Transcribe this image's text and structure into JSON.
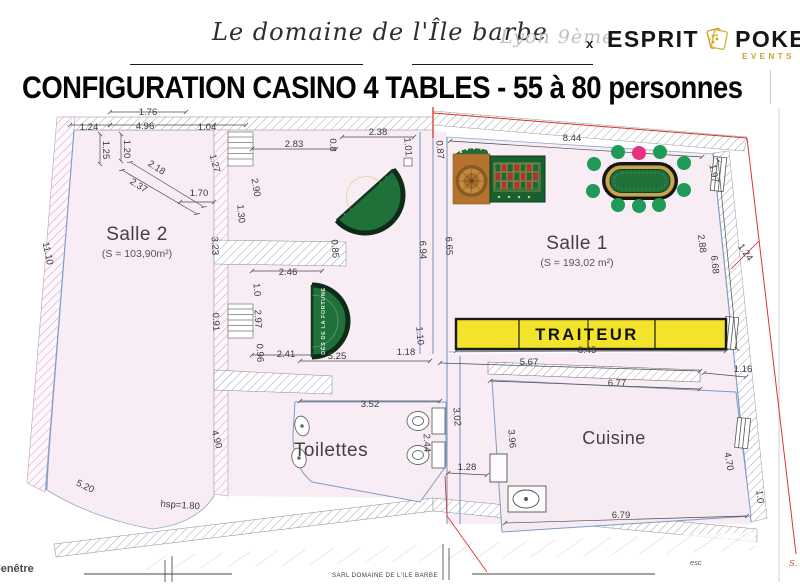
{
  "header": {
    "venue_name": "Le domaine de l'Île barbe",
    "venue_location": "Lyon 9ème",
    "collab_x": "x",
    "brand_left": "ESPRIT",
    "brand_right": "POKER",
    "brand_sub": "EVENTS",
    "title": "CONFIGURATION CASINO 4 TABLES - 55 à 80 personnes"
  },
  "plan": {
    "rooms": [
      {
        "name": "Salle 2",
        "area": "(S = 103,90m²)"
      },
      {
        "name": "Salle 1",
        "area": "(S = 193,02 m²)"
      },
      {
        "name": "Toilettes",
        "area": ""
      },
      {
        "name": "Cuisine",
        "area": ""
      }
    ],
    "traiteur_label": "TRAITEUR",
    "fortune_table_label": "DÉS DE LA FORTUNE",
    "footer": {
      "fenetre": "Fenêtre",
      "sarl": "SARL DOMAINE DE L'ILE BARBE",
      "esc": "esc",
      "s_mark": "S."
    },
    "colors": {
      "banner_yellow": "#f3e32b",
      "felt_green": "#20703a",
      "chair_green": "#1f9a57",
      "chair_pink": "#e8317e",
      "wood_brown": "#b4722f",
      "wall_blue": "#7e9cc5",
      "boundary_red": "#d9342b",
      "brand_gold": "#c9a227",
      "room_pink": "#f8edf4"
    },
    "poker_chairs": [
      {
        "x": 618,
        "y": 48,
        "pink": false
      },
      {
        "x": 639,
        "y": 49,
        "pink": true
      },
      {
        "x": 660,
        "y": 48,
        "pink": false
      },
      {
        "x": 594,
        "y": 60,
        "pink": false
      },
      {
        "x": 684,
        "y": 59,
        "pink": false
      },
      {
        "x": 593,
        "y": 87,
        "pink": false
      },
      {
        "x": 684,
        "y": 86,
        "pink": false
      },
      {
        "x": 618,
        "y": 101,
        "pink": false
      },
      {
        "x": 639,
        "y": 102,
        "pink": false
      },
      {
        "x": 659,
        "y": 101,
        "pink": false
      }
    ],
    "dimensions": [
      {
        "t": "1.76",
        "x": 148,
        "y": 11,
        "r": 0
      },
      {
        "t": "1.24",
        "x": 89,
        "y": 26,
        "r": 0
      },
      {
        "t": "4.96",
        "x": 145,
        "y": 25,
        "r": 0
      },
      {
        "t": "1.04",
        "x": 207,
        "y": 26,
        "r": 0
      },
      {
        "t": "1.25",
        "x": 103,
        "y": 46,
        "r": 90
      },
      {
        "t": "1.20",
        "x": 124,
        "y": 45,
        "r": 90
      },
      {
        "t": "2.18",
        "x": 155,
        "y": 66,
        "r": 33
      },
      {
        "t": "2.37",
        "x": 137,
        "y": 84,
        "r": 33
      },
      {
        "t": "1.70",
        "x": 199,
        "y": 92,
        "r": 0
      },
      {
        "t": "1.27",
        "x": 212,
        "y": 60,
        "r": 75
      },
      {
        "t": "2.90",
        "x": 253,
        "y": 84,
        "r": 80
      },
      {
        "t": "1.30",
        "x": 238,
        "y": 110,
        "r": 85
      },
      {
        "t": "3.23",
        "x": 212,
        "y": 142,
        "r": 88
      },
      {
        "t": "11.10",
        "x": 45,
        "y": 150,
        "r": 78
      },
      {
        "t": "2.83",
        "x": 294,
        "y": 43,
        "r": 0
      },
      {
        "t": "0.8",
        "x": 330,
        "y": 41,
        "r": 90
      },
      {
        "t": "2.38",
        "x": 378,
        "y": 31,
        "r": 0
      },
      {
        "t": "1.01",
        "x": 405,
        "y": 43,
        "r": 85
      },
      {
        "t": "0.87",
        "x": 437,
        "y": 46,
        "r": 85
      },
      {
        "t": "0.85",
        "x": 332,
        "y": 145,
        "r": 85
      },
      {
        "t": "6.94",
        "x": 420,
        "y": 146,
        "r": 88
      },
      {
        "t": "6.65",
        "x": 446,
        "y": 142,
        "r": 88
      },
      {
        "t": "2.46",
        "x": 288,
        "y": 171,
        "r": 0
      },
      {
        "t": "1.0",
        "x": 254,
        "y": 186,
        "r": 85
      },
      {
        "t": "2.97",
        "x": 255,
        "y": 215,
        "r": 88
      },
      {
        "t": "0.91",
        "x": 213,
        "y": 218,
        "r": 88
      },
      {
        "t": "0.96",
        "x": 257,
        "y": 249,
        "r": 88
      },
      {
        "t": "2.41",
        "x": 286,
        "y": 253,
        "r": 0
      },
      {
        "t": "5.25",
        "x": 337,
        "y": 255,
        "r": 0
      },
      {
        "t": "1.18",
        "x": 406,
        "y": 251,
        "r": 0
      },
      {
        "t": "1.10",
        "x": 417,
        "y": 232,
        "r": 85
      },
      {
        "t": "8.44",
        "x": 572,
        "y": 37,
        "r": 0
      },
      {
        "t": "1.97",
        "x": 711,
        "y": 70,
        "r": 80
      },
      {
        "t": "2.88",
        "x": 699,
        "y": 140,
        "r": 82
      },
      {
        "t": "6.68",
        "x": 712,
        "y": 161,
        "r": 84
      },
      {
        "t": "1.24",
        "x": 743,
        "y": 150,
        "r": 55
      },
      {
        "t": "8.45",
        "x": 587,
        "y": 249,
        "r": 0
      },
      {
        "t": "5.67",
        "x": 529,
        "y": 261,
        "r": 0
      },
      {
        "t": "1.16",
        "x": 743,
        "y": 268,
        "r": 0
      },
      {
        "t": "6.77",
        "x": 617,
        "y": 282,
        "r": 0
      },
      {
        "t": "3.52",
        "x": 370,
        "y": 303,
        "r": 0
      },
      {
        "t": "2.44",
        "x": 424,
        "y": 339,
        "r": 88
      },
      {
        "t": "3.02",
        "x": 454,
        "y": 313,
        "r": 85
      },
      {
        "t": "3.96",
        "x": 509,
        "y": 335,
        "r": 85
      },
      {
        "t": "1.28",
        "x": 467,
        "y": 366,
        "r": 0
      },
      {
        "t": "4.70",
        "x": 726,
        "y": 358,
        "r": 80
      },
      {
        "t": "1.0",
        "x": 757,
        "y": 393,
        "r": 85
      },
      {
        "t": "6.79",
        "x": 621,
        "y": 414,
        "r": 0
      },
      {
        "t": "4.90",
        "x": 214,
        "y": 336,
        "r": 75
      },
      {
        "t": "5.20",
        "x": 84,
        "y": 385,
        "r": 25
      },
      {
        "t": "hsp=1.80",
        "x": 180,
        "y": 404,
        "r": 4
      }
    ]
  }
}
